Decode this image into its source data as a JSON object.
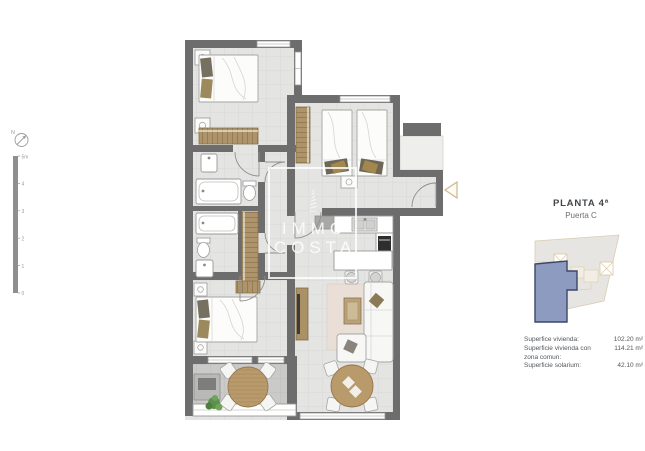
{
  "plan": {
    "watermark": {
      "line1": "IMMO",
      "line2": "COSTA"
    },
    "compass": {
      "label": "N"
    },
    "scalebar": {
      "labels": [
        "5m",
        "4",
        "3",
        "2",
        "1",
        "0"
      ]
    }
  },
  "legend": {
    "title": "PLANTA 4ª",
    "subtitle": "Puerta C",
    "measurements": [
      {
        "label": "Superfice vivienda:",
        "value": "102.20 m²"
      },
      {
        "label": "Superficie vivienda con",
        "value": "114.21 m²"
      },
      {
        "label": "zona comun:",
        "value": ""
      },
      {
        "label": "Superficie solarium:",
        "value": "42.10 m²"
      }
    ]
  },
  "colors": {
    "wall": "#6d6d6d",
    "floor": "#e4e4e3",
    "terrace_floor": "#cacac8",
    "wood": "#ae946a",
    "keyplan_highlight": "#8d9bc0",
    "keyplan_highlight_border": "#3c4768",
    "entrance_marker": "#cbb98b"
  }
}
